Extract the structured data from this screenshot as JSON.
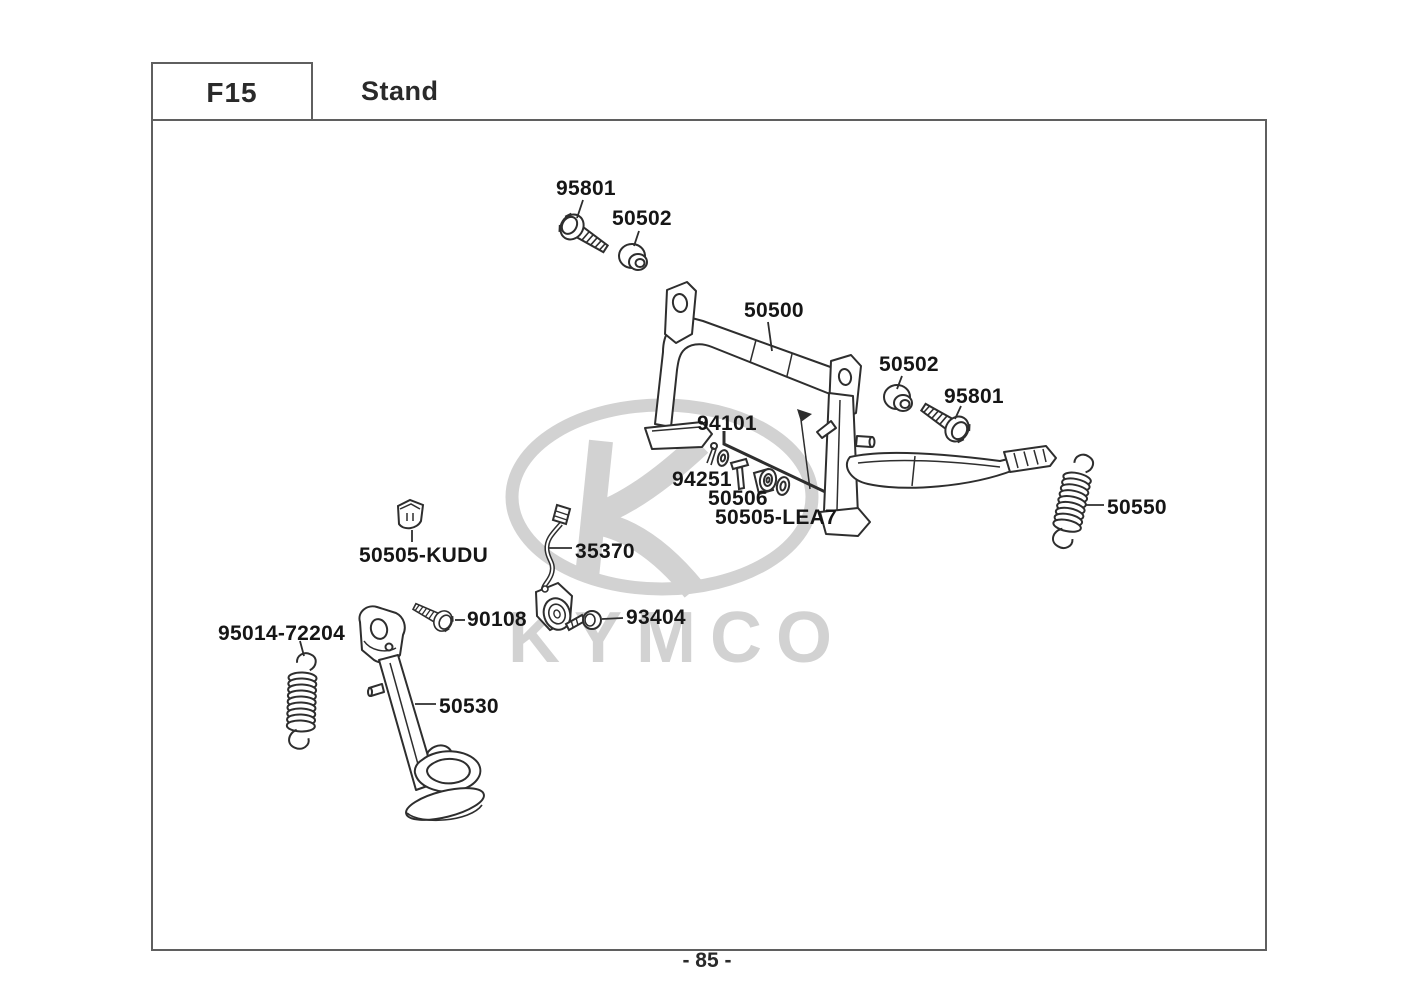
{
  "header": {
    "code": "F15",
    "title": "Stand"
  },
  "footer": {
    "page_number": "- 85 -"
  },
  "watermark": {
    "brand": "KYMCO",
    "color": "#d2d2d2"
  },
  "diagram": {
    "parts": [
      {
        "label": "95801",
        "item": "flange-bolt"
      },
      {
        "label": "50502",
        "item": "rubber-grommet"
      },
      {
        "label": "50500",
        "item": "main-stand"
      },
      {
        "label": "50502",
        "item": "rubber-grommet"
      },
      {
        "label": "95801",
        "item": "flange-bolt"
      },
      {
        "label": "94101",
        "item": "stand-pivot-pin"
      },
      {
        "label": "94251",
        "item": "cotter-pin-and-washer"
      },
      {
        "label": "50506",
        "item": "clevis-pin"
      },
      {
        "label": "50505-LEA7",
        "item": "roller-and-washer"
      },
      {
        "label": "50550",
        "item": "main-stand-spring"
      },
      {
        "label": "50505-KUDU",
        "item": "rubber-stopper"
      },
      {
        "label": "35370",
        "item": "side-stand-switch"
      },
      {
        "label": "90108",
        "item": "pivot-bolt"
      },
      {
        "label": "93404",
        "item": "screw-washer"
      },
      {
        "label": "95014-72204",
        "item": "side-stand-spring"
      },
      {
        "label": "50530",
        "item": "side-stand"
      }
    ]
  }
}
